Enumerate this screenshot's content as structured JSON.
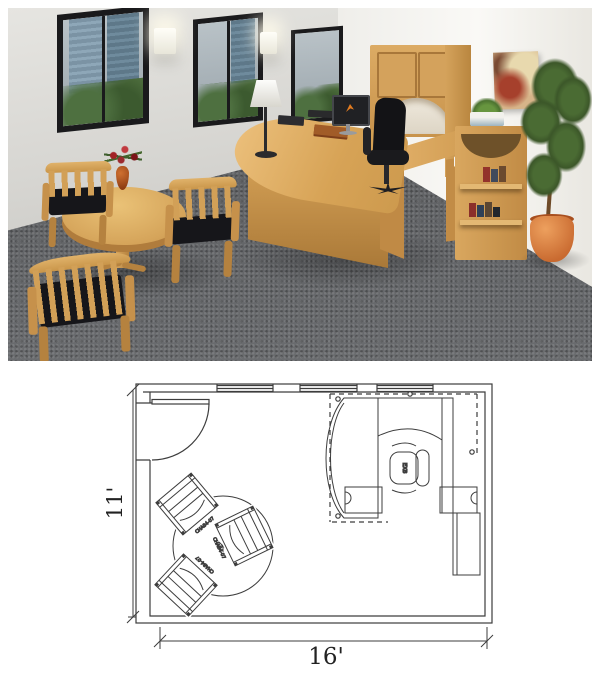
{
  "palette": {
    "wood": "#d4a15c",
    "wood-dark": "#b5823f",
    "carpet": "#626467",
    "frame": "#1a1a1c",
    "seat": "#16161a",
    "accent": "#e07b20",
    "flower": "#a32126",
    "pot": "#d1763a",
    "plan-line": "#3d3d3d"
  },
  "floor_plan": {
    "width_label": "16'",
    "height_label": "11'",
    "chair_labels": [
      "CHA84-07",
      "CHA84-07",
      "CHA84-07"
    ],
    "desk_chair_label": "EX8"
  }
}
